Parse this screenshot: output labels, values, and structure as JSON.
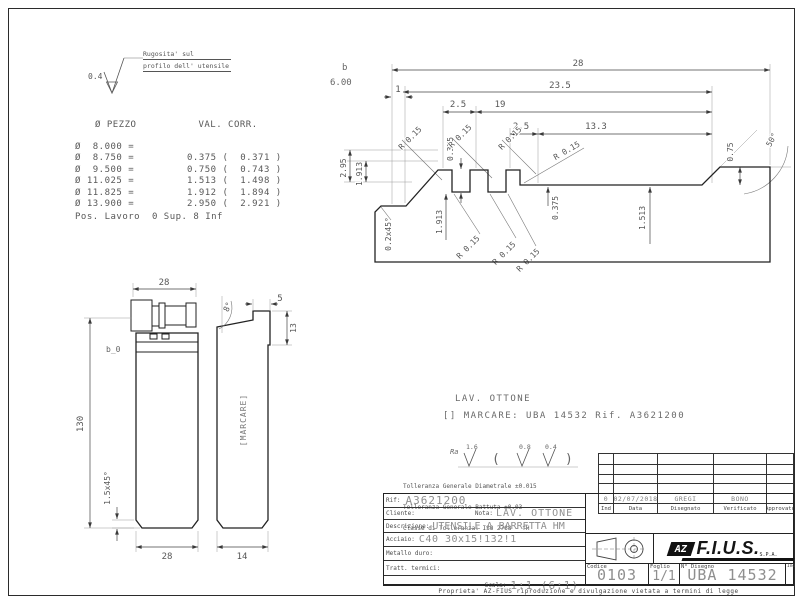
{
  "colors": {
    "label": "#4d4d4d",
    "cad": "#8f8f8f",
    "line": "#2b2b2b"
  },
  "roughness_note": {
    "value": "0.4",
    "line1": "Rugosita' sul",
    "line2": "profilo dell' utensile"
  },
  "correction_table": {
    "col1": "Ø PEZZO",
    "col2": "VAL. CORR.",
    "rows": [
      [
        "Ø  8.000 =",
        ""
      ],
      [
        "Ø  8.750 =",
        "0.375 (  0.371 )"
      ],
      [
        "Ø  9.500 =",
        "0.750 (  0.743 )"
      ],
      [
        "Ø 11.025 =",
        "1.513 (  1.498 )"
      ],
      [
        "Ø 11.825 =",
        "1.912 (  1.894 )"
      ],
      [
        "Ø 13.900 =",
        "2.950 (  2.921 )"
      ]
    ],
    "footer": "Pos. Lavoro  0 Sup. 8 Inf"
  },
  "profile_view": {
    "b_label": "b",
    "b_value": "6.00",
    "w1": "1",
    "w28": "28",
    "w23_5": "23.5",
    "w2_5": "2.5",
    "w19": "19",
    "w2_5b": "2.5",
    "w13_3": "13.3",
    "v2_95": "2.95",
    "v1_913": "1.913",
    "v0_375": "0.375",
    "v1_513": "1.513",
    "v0_75": "0.75",
    "a50": "50°",
    "cham": "0.2x45°",
    "r": "R 0.15"
  },
  "front_view": {
    "w_top": "28",
    "h": "130",
    "b0": "b_0",
    "cham": "1.5x45°",
    "w_bottom": "28"
  },
  "side_view": {
    "w_top": "5",
    "h_insert": "13",
    "angle": "8°",
    "marking": "[MARCARE]",
    "w_bottom": "14"
  },
  "notes": {
    "lav": "LAV. OTTONE",
    "marcare": "[] MARCARE: UBA 14532 Rif. A3621200"
  },
  "finish": {
    "ra": "Ra",
    "v1": "1.6",
    "v2": "0.8",
    "v3": "0.4",
    "open": "(",
    "close": ")"
  },
  "tolerances": {
    "line1": "Tolleranza Generale Diametrale ±0.015",
    "line2": "Tolleranza Generale Battuta ±0.03",
    "line3": "Classe di Tolleranza: ISO 2768 - fH"
  },
  "title_block": {
    "rif_label": "Rif:",
    "rif_value": "A3621200",
    "cliente_label": "Cliente:",
    "nota_label": "Nota:",
    "nota_value": "LAV. OTTONE",
    "descrizione_label": "Descrizione:",
    "descrizione_value": "UTENSILE A BARRETTA HM",
    "acciaio_label": "Acciaio:",
    "acciaio_value": "C40 30x15!132!1",
    "metallo_label": "Metallo duro:",
    "tratt_label": "Tratt. termici:",
    "scala_label": "Scala:",
    "scala_value": "1:1 (6:1)",
    "revisions": {
      "headers": [
        "Ind",
        "Data",
        "Disegnato",
        "Verificato",
        "Approvato"
      ],
      "row": [
        "0",
        "02/07/2018",
        "GREGI",
        "BONO",
        ""
      ]
    },
    "codice_label": "Codice",
    "codice_value": "0103",
    "foglio_label": "Foglio",
    "foglio_value": "1/1",
    "disegno_label": "N° Disegno",
    "disegno_value": "UBA 14532",
    "ind_label": "Ind",
    "logo": {
      "az": "AZ",
      "name": "F.I.U.S.",
      "spa": "S.P.A."
    }
  },
  "footer_text": "Proprieta' AZ-FIUS riproduzione e divulgazione vietata a termini di legge"
}
